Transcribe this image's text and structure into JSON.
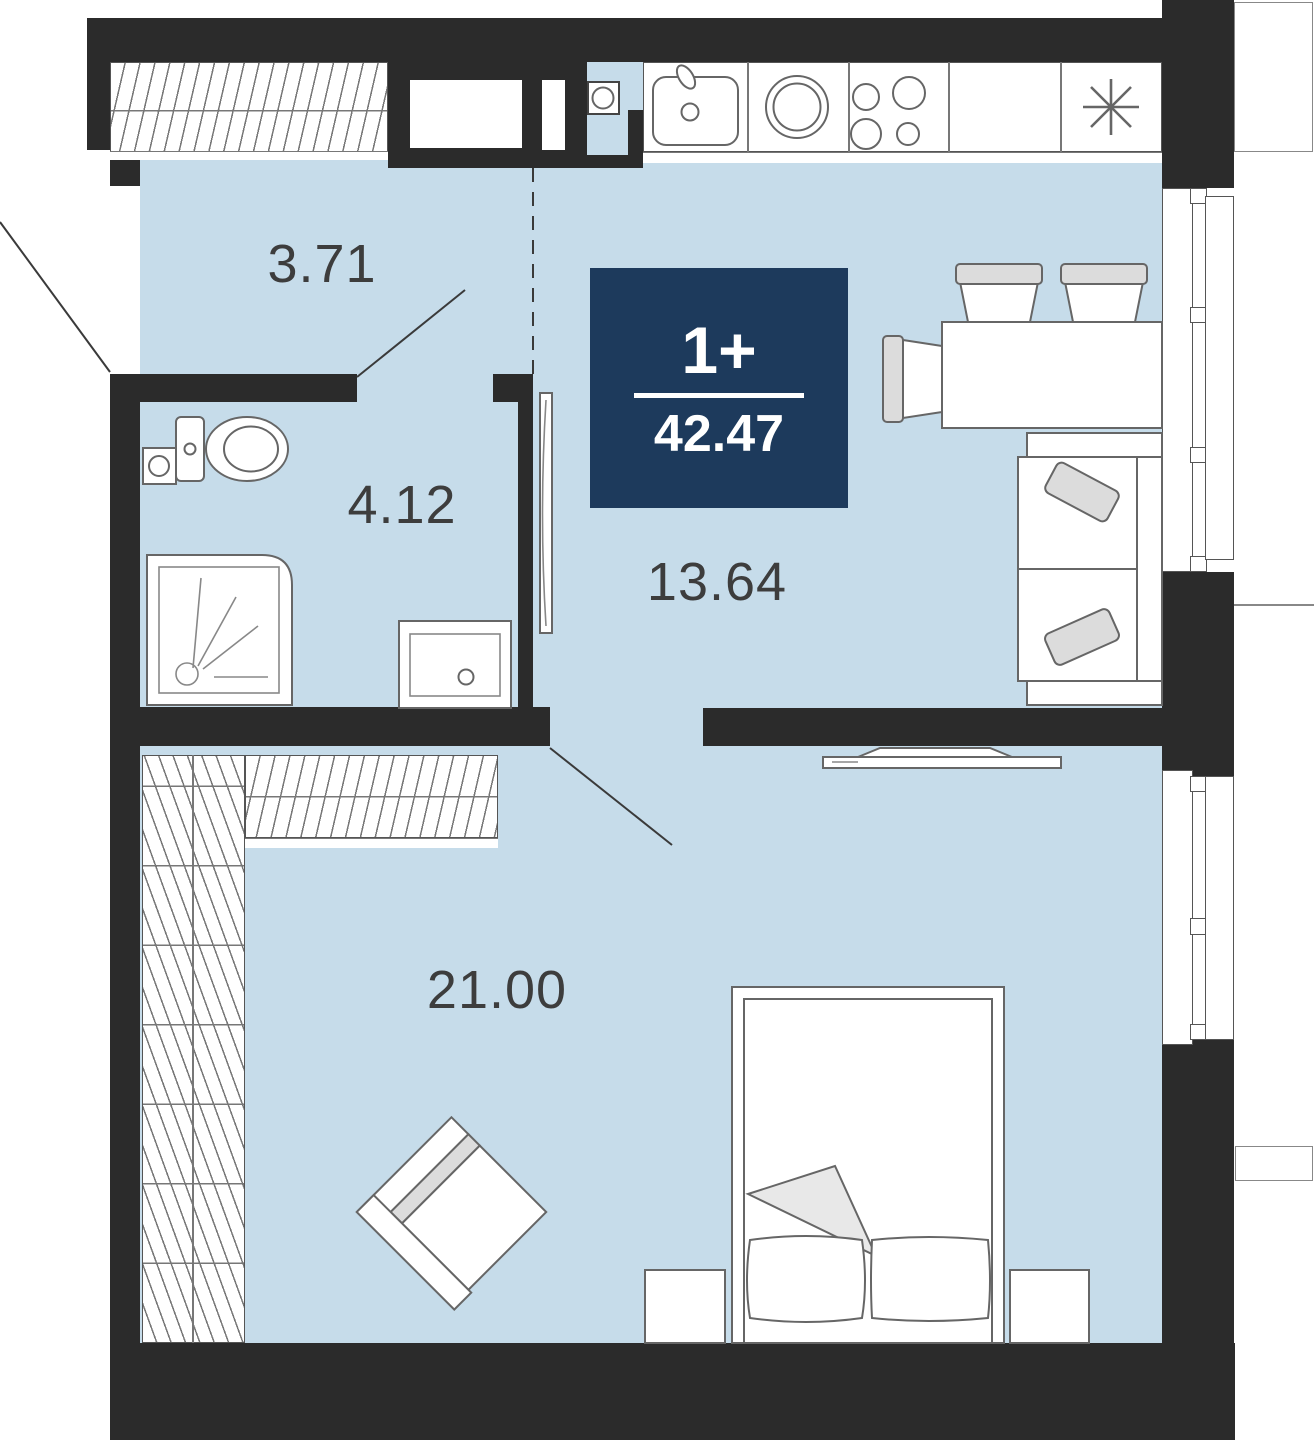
{
  "badge": {
    "rooms_label": "1+",
    "total_area": "42.47"
  },
  "rooms": [
    {
      "id": "hallway",
      "area": "3.71"
    },
    {
      "id": "bathroom",
      "area": "4.12"
    },
    {
      "id": "kitchen_living",
      "area": "13.64"
    },
    {
      "id": "bedroom",
      "area": "21.00"
    }
  ],
  "fixtures": [
    "wardrobe-hatch",
    "washing-machine",
    "kitchen-sink",
    "round-bowl",
    "cooktop-4-burners",
    "fridge-asterisk",
    "toilet",
    "shower-tray",
    "washbasin",
    "door-leaf",
    "dining-table",
    "chairs",
    "sofa",
    "tv",
    "armchair",
    "double-bed",
    "nightstands",
    "windows",
    "entrance-door"
  ],
  "colors": {
    "wall": "#2b2b2b",
    "floor": "#c6dcea",
    "badge_bg": "#1d3a5c",
    "label_text": "#3d3d3d",
    "stroke": "#666666",
    "accent_fill": "#dcdcdc"
  }
}
